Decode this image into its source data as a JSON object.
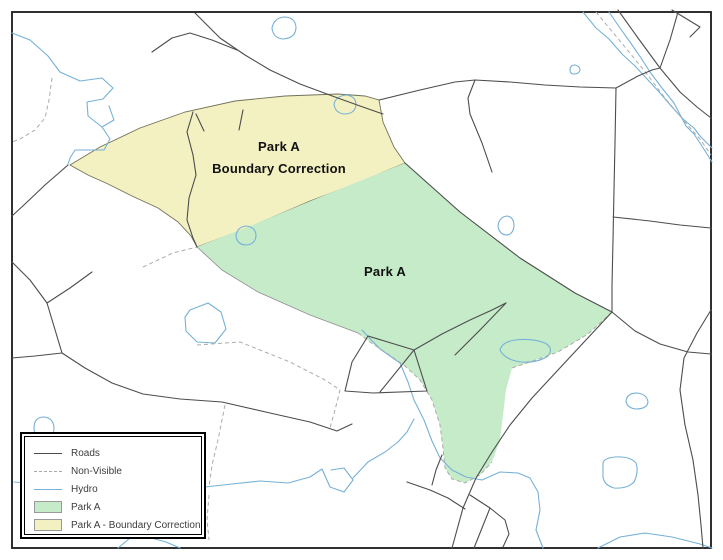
{
  "map": {
    "labels": {
      "park_a": "Park A",
      "correction_line1": "Park A",
      "correction_line2": "Boundary Correction"
    },
    "colors": {
      "park_a_fill": "#c6ebc9",
      "correction_fill": "#f3f0c2",
      "hydro": "#76b1d6",
      "road": "#4d4d4d",
      "non_visible": "#ababab",
      "frame": "#1a1a1a"
    }
  },
  "legend": {
    "items": [
      {
        "label": "Roads",
        "swatch": "line-solid"
      },
      {
        "label": "Non-Visible",
        "swatch": "line-dashed"
      },
      {
        "label": "Hydro",
        "swatch": "line-hydro"
      },
      {
        "label": "Park A",
        "swatch": "fill-park"
      },
      {
        "label": "Park A - Boundary Correction",
        "swatch": "fill-correction"
      }
    ]
  }
}
